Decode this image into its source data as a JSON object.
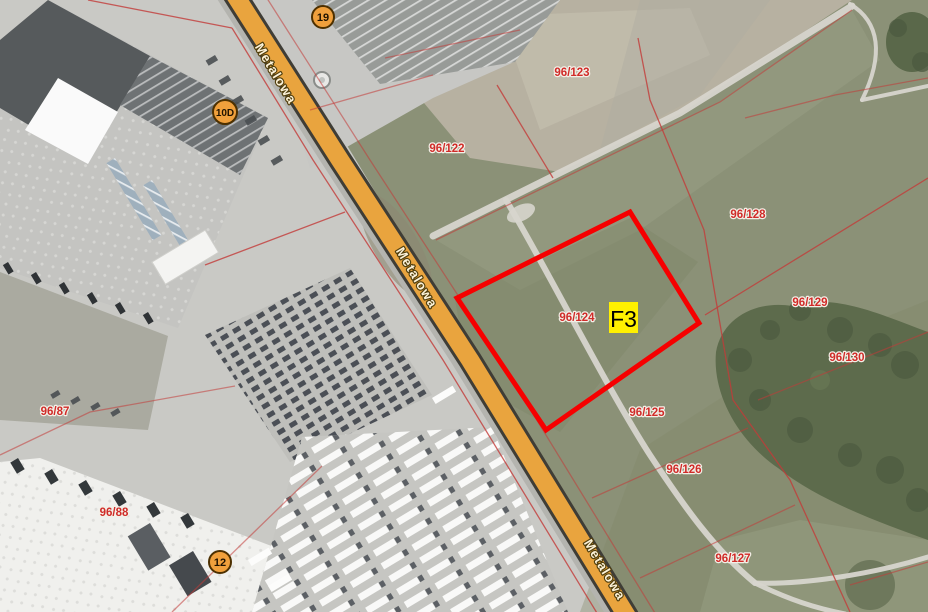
{
  "map": {
    "road_label": "Metalowa",
    "highlight_label": "F3",
    "markers": [
      {
        "label": "19"
      },
      {
        "label": "10D"
      },
      {
        "label": "12"
      }
    ],
    "parcel_labels": [
      "96/122",
      "96/123",
      "96/124",
      "96/125",
      "96/126",
      "96/127",
      "96/128",
      "96/129",
      "96/130",
      "96/87",
      "96/88"
    ]
  },
  "colors": {
    "road_fill": "#E9A43E",
    "road_casing": "#3F3D36",
    "parcel_line": "#C33B38",
    "parcel_text": "#D02B28",
    "highlight_outline": "#F60000",
    "highlight_label_bg": "#FFF000",
    "marker_fill": "#F0A03C",
    "marker_border": "#4D3000"
  }
}
